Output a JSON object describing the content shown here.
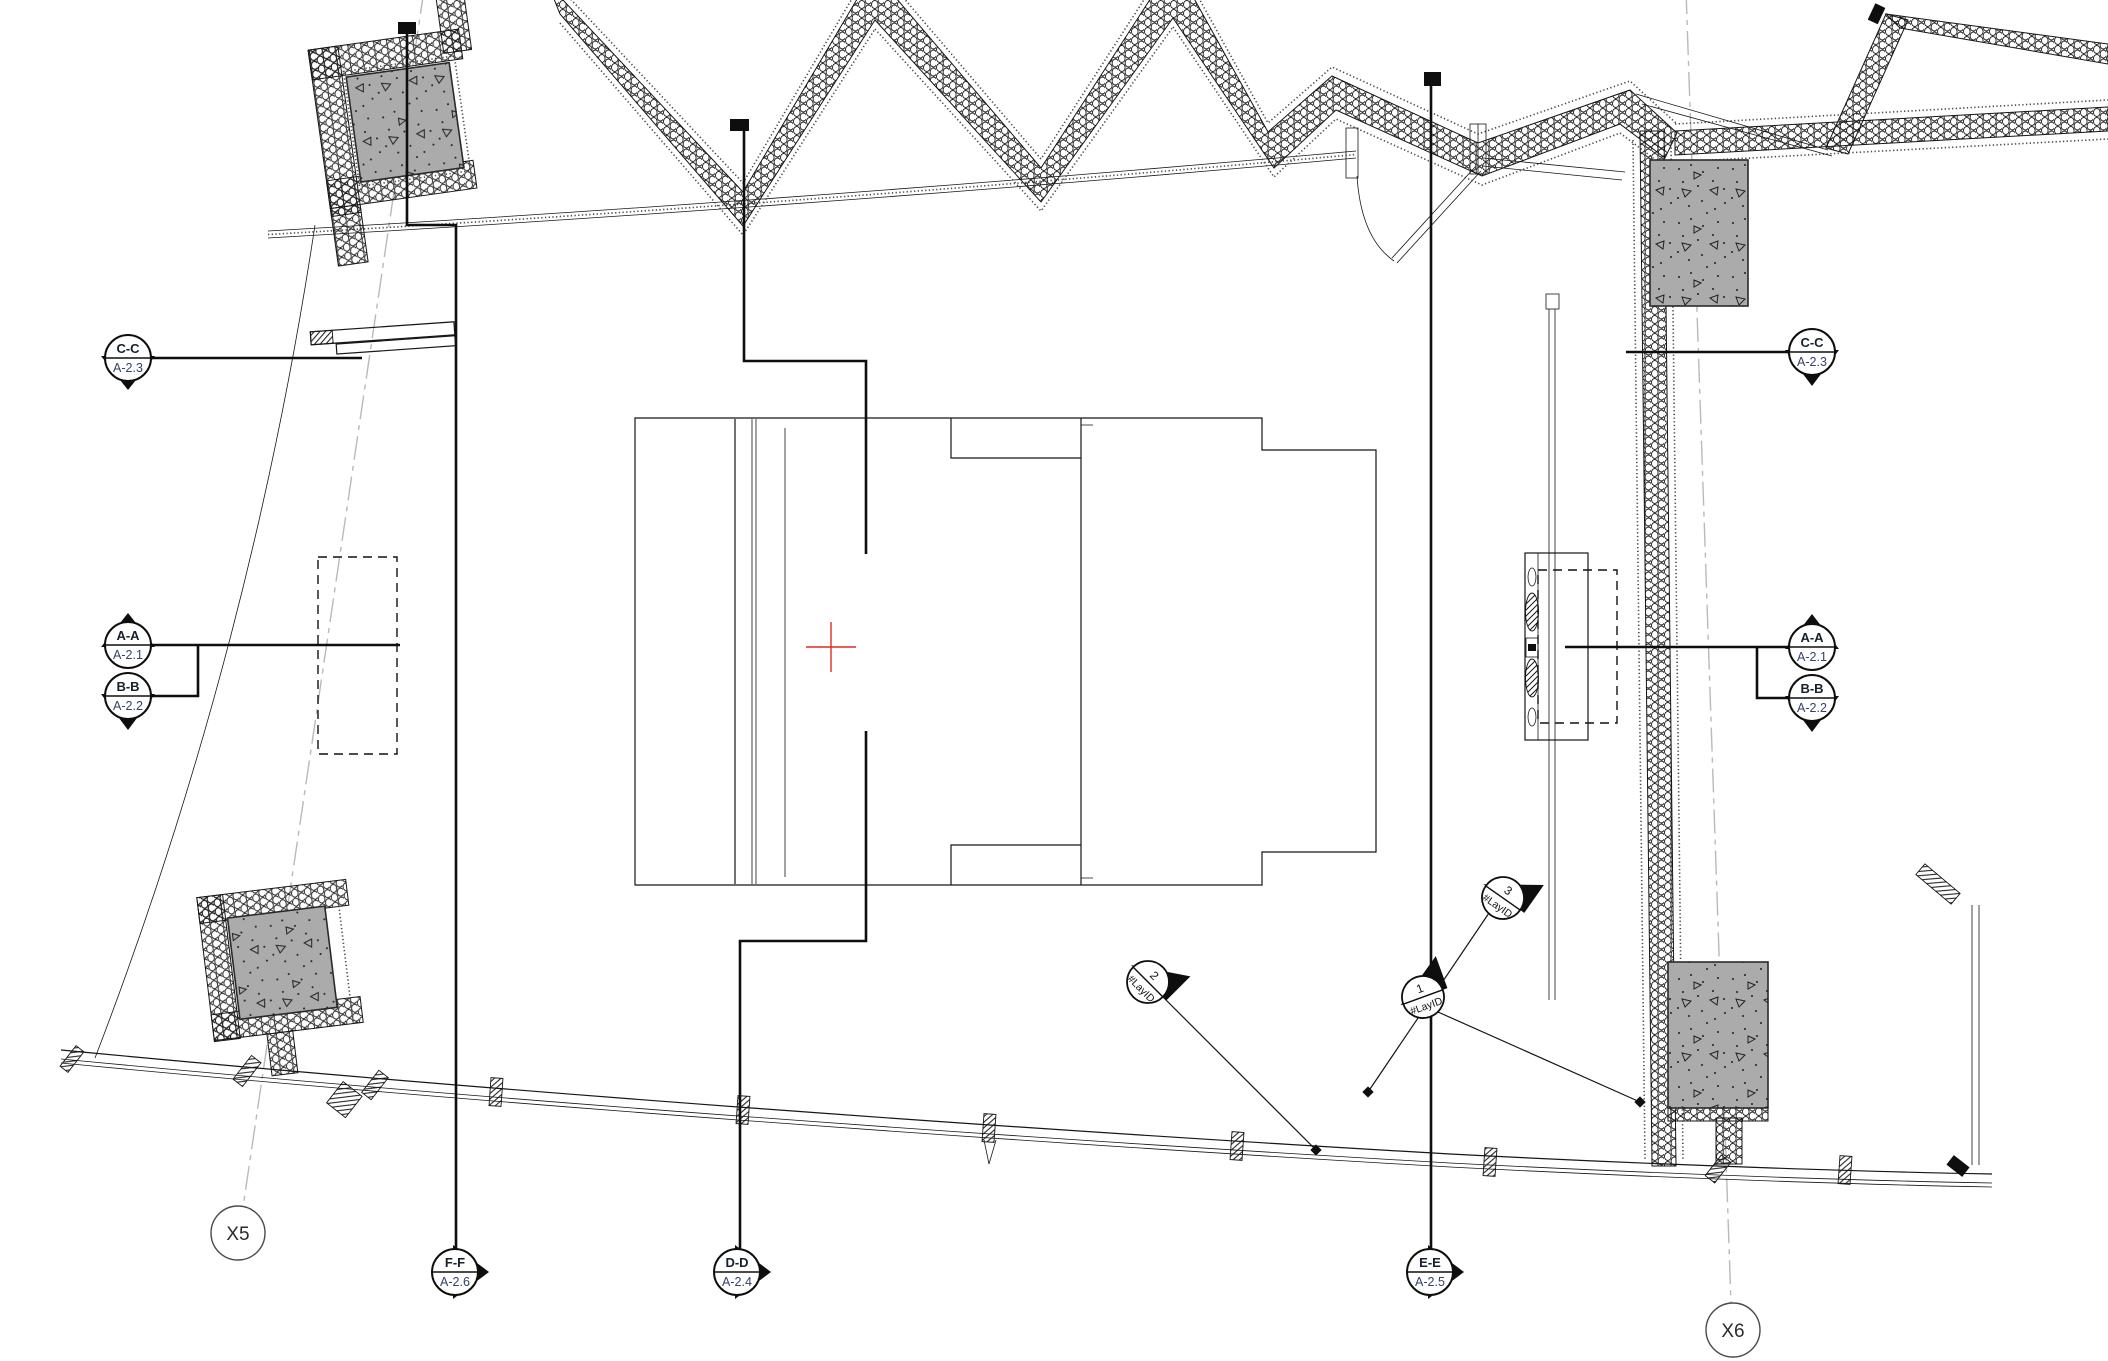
{
  "drawing": {
    "type": "architectural-floor-plan",
    "origin_marker": "+"
  },
  "colors": {
    "line": "#161616",
    "grid_line": "#b9b9b9",
    "column_fill": "#ababab",
    "origin_red": "#e02a22",
    "sheet_ref_text": "#33416b"
  },
  "markers": [
    {
      "id": "cc-left",
      "label": "C-C",
      "sheet": "A-2.3"
    },
    {
      "id": "aa-left",
      "label": "A-A",
      "sheet": "A-2.1"
    },
    {
      "id": "bb-left",
      "label": "B-B",
      "sheet": "A-2.2"
    },
    {
      "id": "cc-right",
      "label": "C-C",
      "sheet": "A-2.3"
    },
    {
      "id": "aa-right",
      "label": "A-A",
      "sheet": "A-2.1"
    },
    {
      "id": "bb-right",
      "label": "B-B",
      "sheet": "A-2.2"
    },
    {
      "id": "ff-bottom",
      "label": "F-F",
      "sheet": "A-2.6"
    },
    {
      "id": "dd-bottom",
      "label": "D-D",
      "sheet": "A-2.4"
    },
    {
      "id": "ee-bottom",
      "label": "E-E",
      "sheet": "A-2.5"
    }
  ],
  "grid_bubbles": [
    {
      "id": "x5",
      "label": "X5"
    },
    {
      "id": "x6",
      "label": "X6"
    }
  ],
  "detail_callouts": [
    {
      "id": "c3",
      "number": "3",
      "ref": "#LayID"
    },
    {
      "id": "c1",
      "number": "1",
      "ref": "#LayID"
    },
    {
      "id": "c2",
      "number": "2",
      "ref": "#LayID"
    }
  ]
}
